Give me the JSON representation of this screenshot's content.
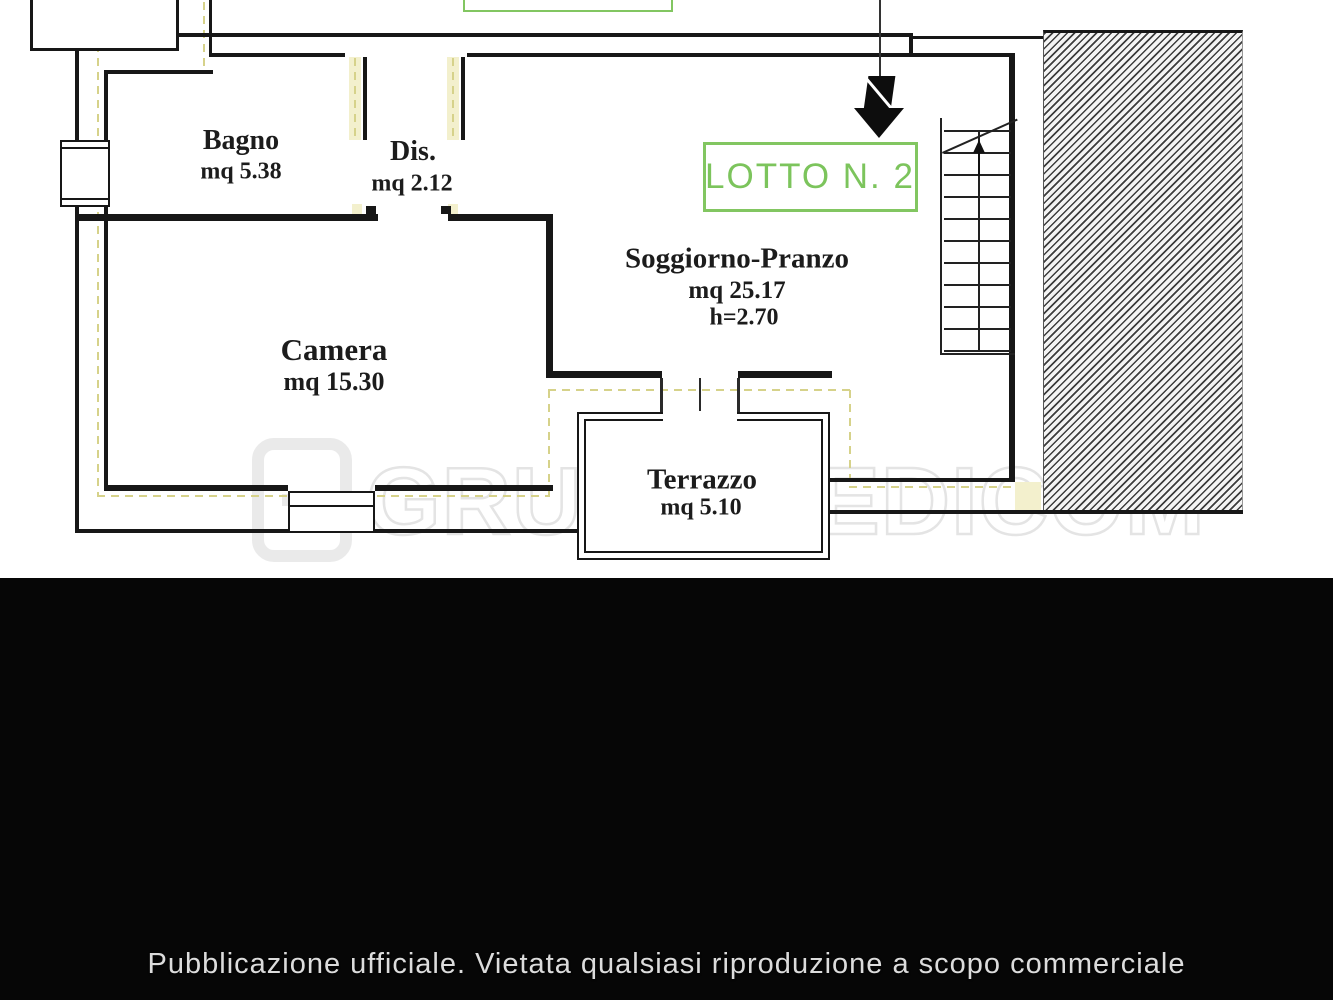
{
  "plan": {
    "lot_label": "LOTTO N. 2",
    "rooms": [
      {
        "name": "Bagno",
        "area": "mq 5.38"
      },
      {
        "name": "Dis.",
        "area": "mq 2.12"
      },
      {
        "name": "Camera",
        "area": "mq 15.30"
      },
      {
        "name": "Soggiorno-Pranzo",
        "area": "mq 25.17",
        "height": "h=2.70"
      },
      {
        "name": "Terrazzo",
        "area": "mq 5.10"
      }
    ],
    "colors": {
      "lot_green": "#7cc45c",
      "wall_black": "#171717",
      "insulation_yellow": "#d6d28a"
    }
  },
  "watermark": {
    "text": "GRUPPO EDICOM"
  },
  "footer": {
    "text": "Pubblicazione ufficiale. Vietata qualsiasi riproduzione a scopo commerciale"
  }
}
